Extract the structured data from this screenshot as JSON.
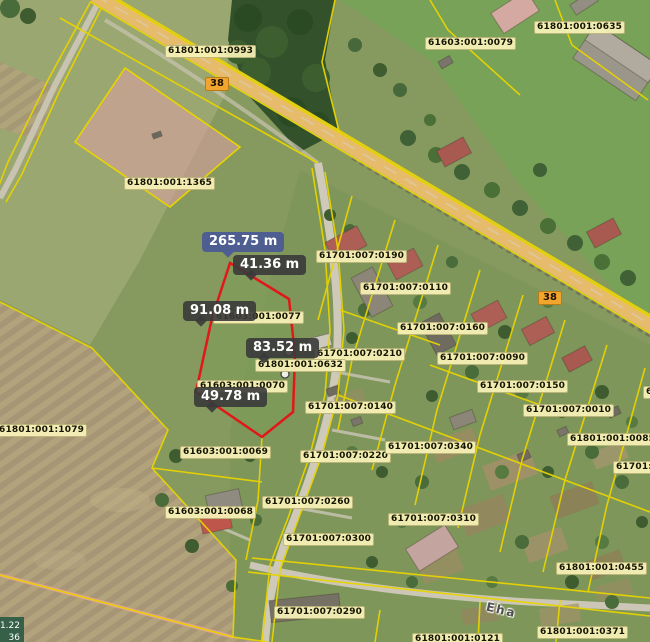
{
  "app": {
    "description": "Cadastral web map with parcel measurement overlay"
  },
  "map": {
    "parcel_labels": [
      {
        "text": "61801:001:0993",
        "x": 165,
        "y": 45
      },
      {
        "text": "61603:001:0079",
        "x": 425,
        "y": 37
      },
      {
        "text": "61801:001:0635",
        "x": 534,
        "y": 21
      },
      {
        "text": "61801:001:1365",
        "x": 124,
        "y": 177
      },
      {
        "text": "61701:007:0190",
        "x": 316,
        "y": 250
      },
      {
        "text": "61701:007:0110",
        "x": 360,
        "y": 282
      },
      {
        "text": "61701:007:0160",
        "x": 397,
        "y": 322
      },
      {
        "text": "61701:007:0210",
        "x": 314,
        "y": 348
      },
      {
        "text": "61701:007:0090",
        "x": 437,
        "y": 352
      },
      {
        "text": "61701:007:0150",
        "x": 477,
        "y": 380
      },
      {
        "text": "61701:007:0140",
        "x": 305,
        "y": 401
      },
      {
        "text": "61701:007:0010",
        "x": 523,
        "y": 404
      },
      {
        "text": "61801:001:0085",
        "x": 567,
        "y": 433
      },
      {
        "text": "61701:0",
        "x": 613,
        "y": 461
      },
      {
        "text": "61603:001:0077",
        "x": 213,
        "y": 311
      },
      {
        "text": "61801:001:0632",
        "x": 255,
        "y": 359
      },
      {
        "text": "61603:001:0070",
        "x": 197,
        "y": 380
      },
      {
        "text": "61603:001:0069",
        "x": 180,
        "y": 446
      },
      {
        "text": "61701:007:0220",
        "x": 300,
        "y": 450
      },
      {
        "text": "61701:007:0340",
        "x": 385,
        "y": 441
      },
      {
        "text": "61603:001:0068",
        "x": 165,
        "y": 506
      },
      {
        "text": "61701:007:0260",
        "x": 262,
        "y": 496
      },
      {
        "text": "61701:007:0310",
        "x": 388,
        "y": 513
      },
      {
        "text": "61701:007:0300",
        "x": 283,
        "y": 533
      },
      {
        "text": "61801:001:1079",
        "x": -4,
        "y": 424
      },
      {
        "text": "61801:001:0455",
        "x": 556,
        "y": 562
      },
      {
        "text": "61701:007:0290",
        "x": 274,
        "y": 606
      },
      {
        "text": "61801:001:0371",
        "x": 537,
        "y": 626
      },
      {
        "text": "61801:001:0121",
        "x": 412,
        "y": 633
      },
      {
        "text": "6",
        "x": 643,
        "y": 386
      }
    ],
    "road_badges": [
      {
        "text": "38",
        "x": 205,
        "y": 77
      },
      {
        "text": "38",
        "x": 538,
        "y": 291
      }
    ],
    "street_names": [
      {
        "text": "Eha",
        "x": 486,
        "y": 603,
        "rotation": 13
      }
    ],
    "coordinate_readout": {
      "lines": [
        "1.22",
        "36"
      ]
    },
    "colors": {
      "boundary_yellow": "#e8d400",
      "selection_red": "#e01818",
      "measure_tooltip_bg": "#3a3a3a",
      "measure_total_bg": "#4d5c93",
      "parcel_label_bg": "#f8f2b8",
      "road_badge_bg": "#f2a52e",
      "highlight_parcel_fill": "#d8a09e"
    }
  },
  "measurement": {
    "total": {
      "label": "265.75 m",
      "x": 202,
      "y": 232
    },
    "segments": [
      {
        "label": "41.36 m",
        "x": 233,
        "y": 255
      },
      {
        "label": "91.08 m",
        "x": 183,
        "y": 301
      },
      {
        "label": "83.52 m",
        "x": 246,
        "y": 338
      },
      {
        "label": "49.78 m",
        "x": 194,
        "y": 387
      }
    ]
  }
}
